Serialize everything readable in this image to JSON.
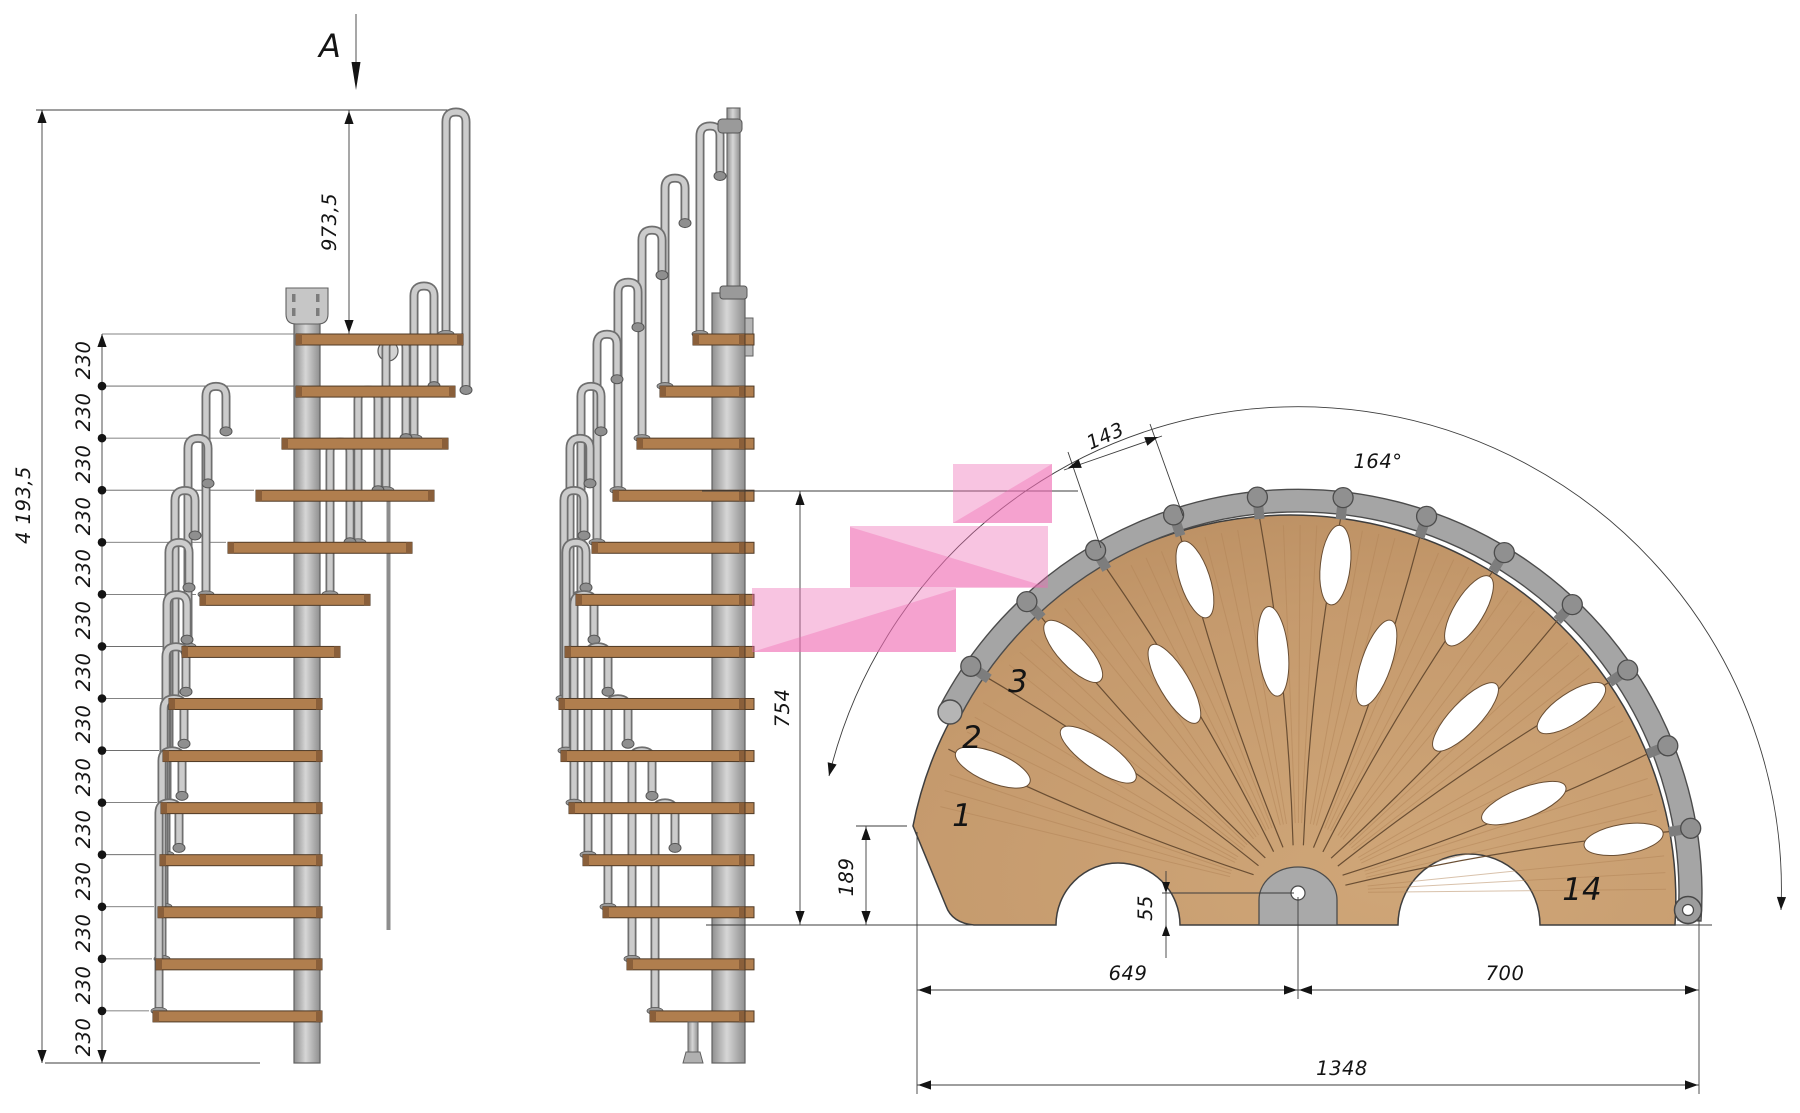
{
  "section_marker": {
    "label": "A"
  },
  "left_elevation": {
    "total_height_label": "4 193,5",
    "top_offset_label": "973,5",
    "riser_label": "230",
    "riser_count": 14
  },
  "plan_view": {
    "arc_angle_label": "164°",
    "step_width_label": "143",
    "height_label": "754",
    "corner_offset_label": "189",
    "pole_offset_label": "55",
    "span_left_label": "649",
    "span_right_label": "700",
    "span_total_label": "1348",
    "step_numbers": {
      "first": "1",
      "second": "2",
      "third": "3",
      "last": "14"
    }
  },
  "colors": {
    "wood_plan": "#c59a6d",
    "wood_plan_dark": "#a87f55",
    "wood_step": "#b07e4e",
    "wood_edge": "#4f3a26",
    "steel_light": "#cccccc",
    "steel_mid": "#a9a9a9",
    "steel_dark": "#6f6f6f",
    "outline": "#3e3e3e",
    "dim_line": "#3c3c3c",
    "highlight_pink": "#ee6cb4"
  }
}
